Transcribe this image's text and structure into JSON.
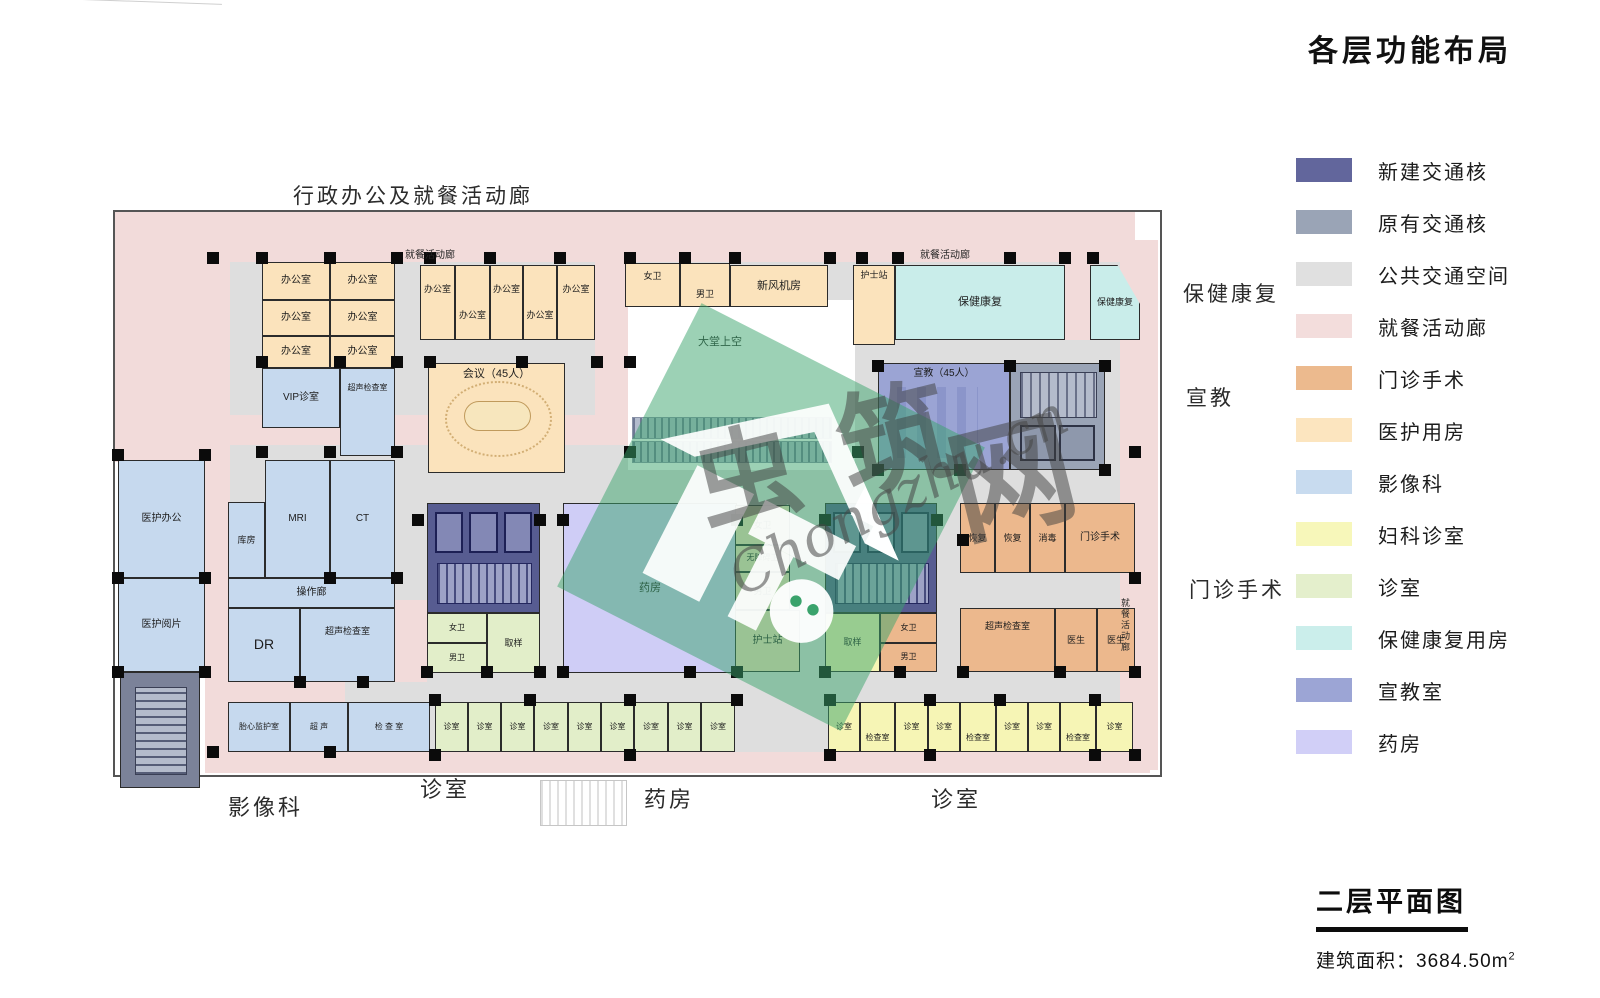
{
  "title": "各层功能布局",
  "legend": [
    {
      "label": "新建交通核",
      "color": "#62669c"
    },
    {
      "label": "原有交通核",
      "color": "#9aa4b6"
    },
    {
      "label": "公共交通空间",
      "color": "#e0e0e0"
    },
    {
      "label": "就餐活动廊",
      "color": "#f3dddc"
    },
    {
      "label": "门诊手术",
      "color": "#ecba8e"
    },
    {
      "label": "医护用房",
      "color": "#fce5bf"
    },
    {
      "label": "影像科",
      "color": "#c8dbef"
    },
    {
      "label": "妇科诊室",
      "color": "#f7f7ba"
    },
    {
      "label": "诊室",
      "color": "#e4efcc"
    },
    {
      "label": "保健康复用房",
      "color": "#cbeeeb"
    },
    {
      "label": "宣教室",
      "color": "#9ca5d5"
    },
    {
      "label": "药房",
      "color": "#d1cff7"
    }
  ],
  "title_block": {
    "floor": "二层平面图",
    "area_prefix": "建筑面积：",
    "area": "3684.50m",
    "area_sup": "2"
  },
  "watermark": {
    "chars": [
      "虫",
      "筑",
      "网"
    ],
    "url": "Chongzhu.cn"
  },
  "zone_colors": {
    "new_core": "#575c91",
    "old_core": "#9aa4b6",
    "old_core_dark": "#7b8299",
    "public": "#dedede",
    "dining": "#f2dbda",
    "surgery": "#ecb88d",
    "medical": "#fbe3bc",
    "imaging": "#c6d9ee",
    "gyn": "#f6f5b5",
    "clinic": "#e2eec9",
    "rehab": "#c9edea",
    "education": "#9ba4d4",
    "pharmacy": "#cfcdf6",
    "white": "#ffffff"
  },
  "rooms": [
    {
      "n": "办公室",
      "x": 262,
      "y": 262,
      "w": 68,
      "h": 38,
      "z": "medical",
      "fs": 10
    },
    {
      "n": "办公室",
      "x": 330,
      "y": 262,
      "w": 65,
      "h": 38,
      "z": "medical",
      "fs": 10
    },
    {
      "n": "办公室",
      "x": 262,
      "y": 300,
      "w": 68,
      "h": 36,
      "z": "medical",
      "fs": 10
    },
    {
      "n": "办公室",
      "x": 330,
      "y": 300,
      "w": 65,
      "h": 36,
      "z": "medical",
      "fs": 10
    },
    {
      "n": "办公室",
      "x": 262,
      "y": 336,
      "w": 68,
      "h": 32,
      "z": "medical",
      "fs": 10
    },
    {
      "n": "办公室",
      "x": 330,
      "y": 336,
      "w": 65,
      "h": 32,
      "z": "medical",
      "fs": 10
    },
    {
      "n": "办公室",
      "x": 420,
      "y": 265,
      "w": 35,
      "h": 75,
      "z": "medical",
      "fs": 9,
      "dy": -13
    },
    {
      "n": "办公室",
      "x": 455,
      "y": 265,
      "w": 35,
      "h": 75,
      "z": "medical",
      "fs": 9,
      "dy": 13
    },
    {
      "n": "办公室",
      "x": 490,
      "y": 265,
      "w": 33,
      "h": 75,
      "z": "medical",
      "fs": 9,
      "dy": -13
    },
    {
      "n": "办公室",
      "x": 523,
      "y": 265,
      "w": 34,
      "h": 75,
      "z": "medical",
      "fs": 9,
      "dy": 13
    },
    {
      "n": "办公室",
      "x": 557,
      "y": 265,
      "w": 38,
      "h": 75,
      "z": "medical",
      "fs": 9,
      "dy": -13
    },
    {
      "n": "会议（45人）",
      "x": 428,
      "y": 363,
      "w": 137,
      "h": 110,
      "z": "medical",
      "fs": 11,
      "va": "t",
      "deco": "conference"
    },
    {
      "n": "女卫",
      "x": 625,
      "y": 263,
      "w": 55,
      "h": 44,
      "z": "medical",
      "fs": 9,
      "dy": -9
    },
    {
      "n": "男卫",
      "x": 680,
      "y": 263,
      "w": 50,
      "h": 44,
      "z": "medical",
      "fs": 9,
      "dy": 9
    },
    {
      "n": "新风机房",
      "x": 730,
      "y": 265,
      "w": 98,
      "h": 42,
      "z": "medical",
      "fs": 11
    },
    {
      "n": "护士站",
      "x": 853,
      "y": 265,
      "w": 42,
      "h": 80,
      "z": "medical",
      "fs": 9,
      "va": "t"
    },
    {
      "n": "保健康复",
      "x": 895,
      "y": 265,
      "w": 170,
      "h": 75,
      "z": "rehab",
      "fs": 11
    },
    {
      "n": "保健康复",
      "x": 1090,
      "y": 265,
      "w": 50,
      "h": 75,
      "z": "rehab",
      "fs": 9,
      "clip": true
    },
    {
      "n": "宣教（45人）",
      "x": 878,
      "y": 363,
      "w": 132,
      "h": 107,
      "z": "education",
      "fs": 10,
      "va": "t",
      "deco": "seats"
    },
    {
      "n": "",
      "x": 1010,
      "y": 363,
      "w": 95,
      "h": 107,
      "z": "old_core",
      "deco": "stair2"
    },
    {
      "n": "VIP诊室",
      "x": 262,
      "y": 368,
      "w": 78,
      "h": 60,
      "z": "imaging",
      "fs": 10
    },
    {
      "n": "超声检查室",
      "x": 340,
      "y": 368,
      "w": 55,
      "h": 88,
      "z": "imaging",
      "fs": 8,
      "dy": -24
    },
    {
      "n": "医护办公",
      "x": 118,
      "y": 460,
      "w": 87,
      "h": 118,
      "z": "imaging",
      "fs": 10
    },
    {
      "n": "医护阅片",
      "x": 118,
      "y": 578,
      "w": 87,
      "h": 94,
      "z": "imaging",
      "fs": 10
    },
    {
      "n": "库房",
      "x": 228,
      "y": 502,
      "w": 37,
      "h": 76,
      "z": "imaging",
      "fs": 9
    },
    {
      "n": "MRI",
      "x": 265,
      "y": 460,
      "w": 65,
      "h": 118,
      "z": "imaging",
      "fs": 10
    },
    {
      "n": "CT",
      "x": 330,
      "y": 460,
      "w": 65,
      "h": 118,
      "z": "imaging",
      "fs": 10
    },
    {
      "n": "操作廊",
      "x": 228,
      "y": 578,
      "w": 167,
      "h": 30,
      "z": "imaging",
      "fs": 10
    },
    {
      "n": "DR",
      "x": 228,
      "y": 608,
      "w": 72,
      "h": 74,
      "z": "imaging",
      "fs": 14
    },
    {
      "n": "超声检查室",
      "x": 300,
      "y": 608,
      "w": 95,
      "h": 74,
      "z": "imaging",
      "fs": 9,
      "dy": -14
    },
    {
      "n": "",
      "x": 427,
      "y": 503,
      "w": 113,
      "h": 110,
      "z": "new_core",
      "deco": "core"
    },
    {
      "n": "女卫",
      "x": 427,
      "y": 613,
      "w": 60,
      "h": 30,
      "z": "clinic",
      "fs": 8
    },
    {
      "n": "男卫",
      "x": 427,
      "y": 643,
      "w": 60,
      "h": 30,
      "z": "clinic",
      "fs": 8
    },
    {
      "n": "取样",
      "x": 487,
      "y": 613,
      "w": 53,
      "h": 60,
      "z": "clinic",
      "fs": 9
    },
    {
      "n": "药房",
      "x": 563,
      "y": 503,
      "w": 174,
      "h": 170,
      "z": "pharmacy",
      "fs": 11
    },
    {
      "n": "女卫",
      "x": 735,
      "y": 505,
      "w": 55,
      "h": 40,
      "z": "medical",
      "fs": 9
    },
    {
      "n": "无障碍卫",
      "x": 735,
      "y": 545,
      "w": 55,
      "h": 27,
      "z": "medical",
      "fs": 8
    },
    {
      "n": "男卫",
      "x": 735,
      "y": 572,
      "w": 55,
      "h": 38,
      "z": "medical",
      "fs": 9
    },
    {
      "n": "护士站",
      "x": 735,
      "y": 610,
      "w": 65,
      "h": 62,
      "z": "medical",
      "fs": 10
    },
    {
      "n": "",
      "x": 825,
      "y": 503,
      "w": 112,
      "h": 110,
      "z": "new_core",
      "deco": "core"
    },
    {
      "n": "取样",
      "x": 825,
      "y": 613,
      "w": 55,
      "h": 59,
      "z": "gyn",
      "fs": 9
    },
    {
      "n": "女卫",
      "x": 880,
      "y": 613,
      "w": 57,
      "h": 30,
      "z": "surgery",
      "fs": 8
    },
    {
      "n": "男卫",
      "x": 880,
      "y": 643,
      "w": 57,
      "h": 29,
      "z": "surgery",
      "fs": 8
    },
    {
      "n": "恢复",
      "x": 960,
      "y": 503,
      "w": 35,
      "h": 70,
      "z": "surgery",
      "fs": 9
    },
    {
      "n": "恢复",
      "x": 995,
      "y": 503,
      "w": 35,
      "h": 70,
      "z": "surgery",
      "fs": 9
    },
    {
      "n": "消毒",
      "x": 1030,
      "y": 503,
      "w": 35,
      "h": 70,
      "z": "surgery",
      "fs": 9
    },
    {
      "n": "门诊手术",
      "x": 1065,
      "y": 503,
      "w": 70,
      "h": 70,
      "z": "surgery",
      "fs": 10
    },
    {
      "n": "超声检查室",
      "x": 960,
      "y": 608,
      "w": 95,
      "h": 64,
      "z": "surgery",
      "fs": 9,
      "dy": -14
    },
    {
      "n": "医生",
      "x": 1055,
      "y": 608,
      "w": 42,
      "h": 64,
      "z": "surgery",
      "fs": 9
    },
    {
      "n": "医生",
      "x": 1097,
      "y": 608,
      "w": 38,
      "h": 64,
      "z": "surgery",
      "fs": 9
    },
    {
      "n": "",
      "x": 120,
      "y": 672,
      "w": 80,
      "h": 116,
      "z": "old_core_dark",
      "deco": "stair1"
    },
    {
      "n": "胎心监护室",
      "x": 228,
      "y": 702,
      "w": 62,
      "h": 50,
      "z": "imaging",
      "fs": 8
    },
    {
      "n": "超 声",
      "x": 290,
      "y": 702,
      "w": 58,
      "h": 50,
      "z": "imaging",
      "fs": 8
    },
    {
      "n": "检 查 室",
      "x": 348,
      "y": 702,
      "w": 82,
      "h": 50,
      "z": "imaging",
      "fs": 8
    },
    {
      "n": "诊室",
      "x": 435,
      "y": 702,
      "w": 33,
      "h": 50,
      "z": "clinic",
      "fs": 8
    },
    {
      "n": "诊室",
      "x": 468,
      "y": 702,
      "w": 33,
      "h": 50,
      "z": "clinic",
      "fs": 8
    },
    {
      "n": "诊室",
      "x": 501,
      "y": 702,
      "w": 33,
      "h": 50,
      "z": "clinic",
      "fs": 8
    },
    {
      "n": "诊室",
      "x": 534,
      "y": 702,
      "w": 34,
      "h": 50,
      "z": "clinic",
      "fs": 8
    },
    {
      "n": "诊室",
      "x": 568,
      "y": 702,
      "w": 33,
      "h": 50,
      "z": "clinic",
      "fs": 8
    },
    {
      "n": "诊室",
      "x": 601,
      "y": 702,
      "w": 33,
      "h": 50,
      "z": "clinic",
      "fs": 8
    },
    {
      "n": "诊室",
      "x": 634,
      "y": 702,
      "w": 34,
      "h": 50,
      "z": "clinic",
      "fs": 8
    },
    {
      "n": "诊室",
      "x": 668,
      "y": 702,
      "w": 33,
      "h": 50,
      "z": "clinic",
      "fs": 8
    },
    {
      "n": "诊室",
      "x": 701,
      "y": 702,
      "w": 34,
      "h": 50,
      "z": "clinic",
      "fs": 8
    },
    {
      "n": "诊室",
      "x": 828,
      "y": 702,
      "w": 32,
      "h": 50,
      "z": "gyn",
      "fs": 8
    },
    {
      "n": "检查室",
      "x": 860,
      "y": 702,
      "w": 35,
      "h": 50,
      "z": "gyn",
      "fs": 8,
      "dy": 11
    },
    {
      "n": "诊室",
      "x": 895,
      "y": 702,
      "w": 33,
      "h": 50,
      "z": "gyn",
      "fs": 8
    },
    {
      "n": "诊室",
      "x": 928,
      "y": 702,
      "w": 32,
      "h": 50,
      "z": "gyn",
      "fs": 8
    },
    {
      "n": "检查室",
      "x": 960,
      "y": 702,
      "w": 36,
      "h": 50,
      "z": "gyn",
      "fs": 8,
      "dy": 11
    },
    {
      "n": "诊室",
      "x": 996,
      "y": 702,
      "w": 32,
      "h": 50,
      "z": "gyn",
      "fs": 8
    },
    {
      "n": "诊室",
      "x": 1028,
      "y": 702,
      "w": 32,
      "h": 50,
      "z": "gyn",
      "fs": 8
    },
    {
      "n": "检查室",
      "x": 1060,
      "y": 702,
      "w": 36,
      "h": 50,
      "z": "gyn",
      "fs": 8,
      "dy": 11
    },
    {
      "n": "诊室",
      "x": 1096,
      "y": 702,
      "w": 37,
      "h": 50,
      "z": "gyn",
      "fs": 8
    }
  ],
  "plan_labels": [
    {
      "t": "就餐活动廊",
      "x": 405,
      "y": 246,
      "fs": 10
    },
    {
      "t": "就餐活动廊",
      "x": 920,
      "y": 246,
      "fs": 10
    },
    {
      "t": "大堂上空",
      "x": 698,
      "y": 333,
      "fs": 11
    },
    {
      "t": "就餐活动廊",
      "x": 1119,
      "y": 598,
      "fs": 9,
      "vert": true
    }
  ],
  "outside_labels": [
    {
      "t": "行政办公及就餐活动廊",
      "x": 293,
      "y": 180,
      "fs": 21
    },
    {
      "t": "保健康复",
      "x": 1183,
      "y": 278,
      "fs": 21
    },
    {
      "t": "宣教",
      "x": 1186,
      "y": 382,
      "fs": 21
    },
    {
      "t": "门诊手术",
      "x": 1189,
      "y": 574,
      "fs": 21
    },
    {
      "t": "影像科",
      "x": 228,
      "y": 790,
      "fs": 22
    },
    {
      "t": "诊室",
      "x": 420,
      "y": 772,
      "fs": 22
    },
    {
      "t": "药房",
      "x": 644,
      "y": 782,
      "fs": 22
    },
    {
      "t": "诊室",
      "x": 931,
      "y": 782,
      "fs": 22
    }
  ]
}
